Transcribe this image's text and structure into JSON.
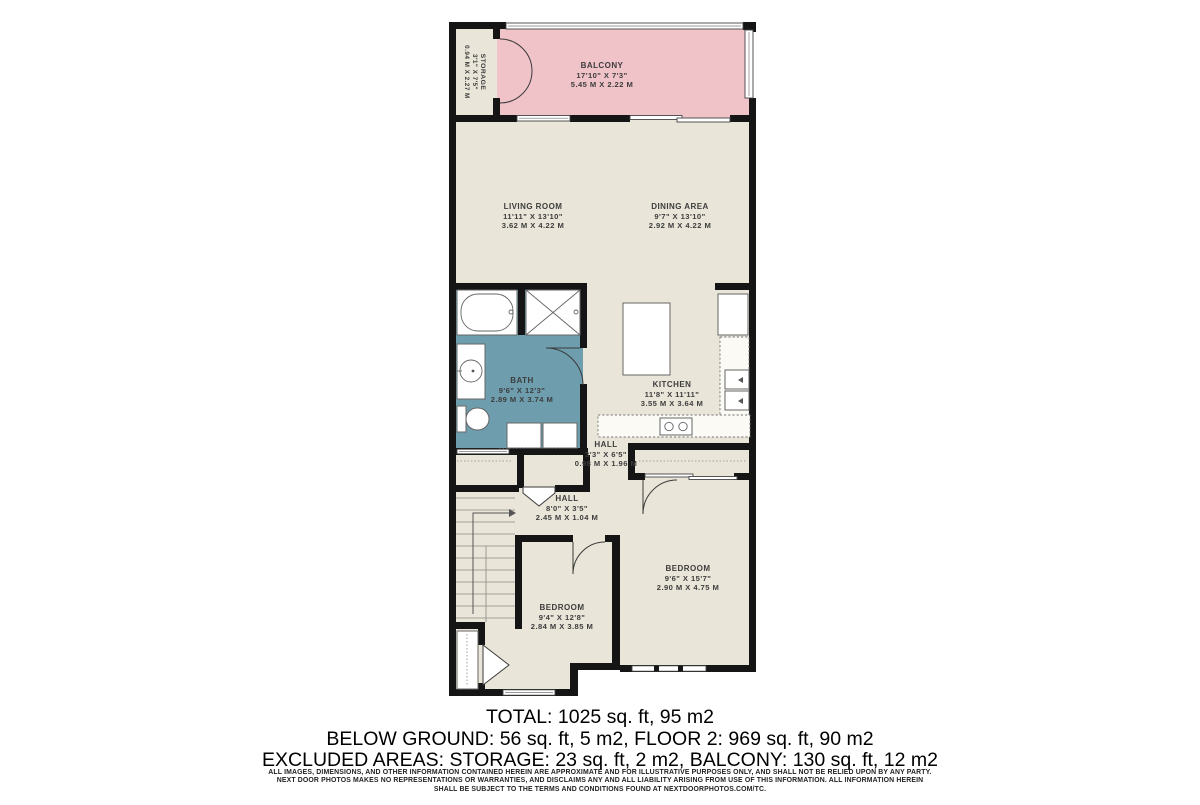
{
  "colors": {
    "wall": "#151515",
    "floor": "#e9e5d8",
    "balcony": "#f0c3c9",
    "bath": "#6e9dad",
    "label": "#3d3d3d"
  },
  "rooms": {
    "storage": {
      "name": "STORAGE",
      "ft": "3'1\" X 7'5\"",
      "m": "0.94 M X 2.27 M"
    },
    "balcony": {
      "name": "BALCONY",
      "ft": "17'10\" X 7'3\"",
      "m": "5.45 M X 2.22 M"
    },
    "living": {
      "name": "LIVING ROOM",
      "ft": "11'11\" X 13'10\"",
      "m": "3.62 M X 4.22 M"
    },
    "dining": {
      "name": "DINING AREA",
      "ft": "9'7\" X 13'10\"",
      "m": "2.92 M X 4.22 M"
    },
    "bath": {
      "name": "BATH",
      "ft": "9'6\" X 12'3\"",
      "m": "2.89 M X 3.74 M"
    },
    "kitchen": {
      "name": "KITCHEN",
      "ft": "11'8\" X 11'11\"",
      "m": "3.55 M X 3.64 M"
    },
    "hall_upper": {
      "name": "HALL",
      "ft": "3'3\" X 6'5\"",
      "m": "0.98 M X 1.96 M"
    },
    "hall_lower": {
      "name": "HALL",
      "ft": "8'0\" X 3'5\"",
      "m": "2.45 M X 1.04 M"
    },
    "bedroom_left": {
      "name": "BEDROOM",
      "ft": "9'4\" X 12'8\"",
      "m": "2.84 M X 3.85 M"
    },
    "bedroom_right": {
      "name": "BEDROOM",
      "ft": "9'6\" X 15'7\"",
      "m": "2.90 M X 4.75 M"
    }
  },
  "summary": {
    "line1": "TOTAL: 1025 sq. ft, 95 m2",
    "line2": "BELOW GROUND: 56 sq. ft, 5 m2, FLOOR 2: 969 sq. ft, 90 m2",
    "line3": "EXCLUDED AREAS: STORAGE: 23 sq. ft, 2 m2, BALCONY: 130 sq. ft, 12 m2"
  },
  "disclaimer": {
    "line1": "ALL IMAGES, DIMENSIONS, AND OTHER INFORMATION CONTAINED HEREIN ARE APPROXIMATE AND FOR ILLUSTRATIVE PURPOSES ONLY, AND SHALL NOT BE RELIED UPON BY ANY PARTY.",
    "line2": "NEXT DOOR PHOTOS MAKES NO REPRESENTATIONS OR WARRANTIES, AND DISCLAIMS ANY AND ALL LIABILITY ARISING FROM USE OF THIS INFORMATION. ALL INFORMATION HEREIN",
    "line3": "SHALL BE SUBJECT TO THE TERMS AND CONDITIONS FOUND AT NEXTDOORPHOTOS.COM/TC."
  }
}
